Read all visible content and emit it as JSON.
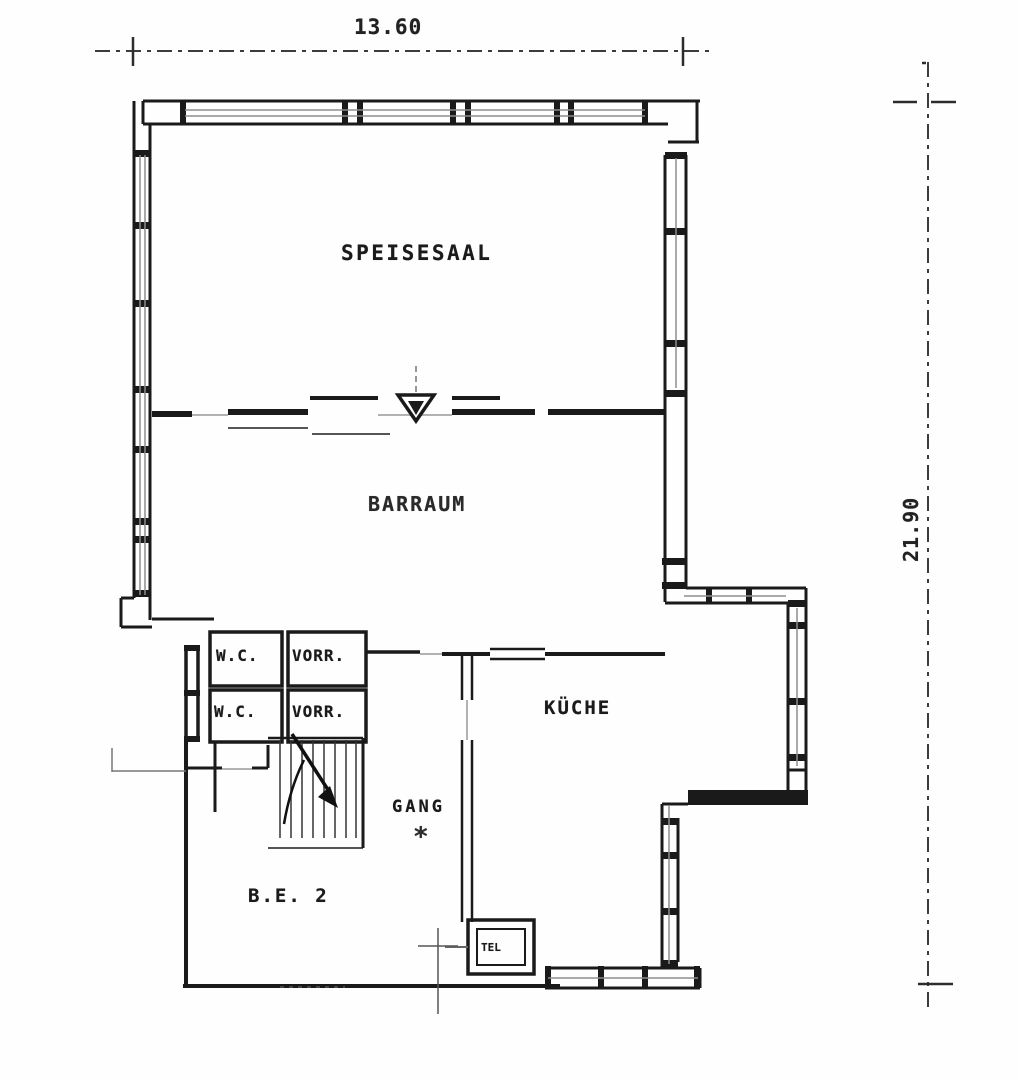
{
  "drawing": {
    "type": "floor-plan",
    "paper_color": "#fefefe",
    "ink_color": "#1a1a1a",
    "glazing_color": "#8d8d8d",
    "dimension_color": "#3c3c3c"
  },
  "dimensions": {
    "width": {
      "label": "13.60"
    },
    "height": {
      "label": "21.90"
    }
  },
  "rooms": {
    "speisesaal": {
      "label": "SPEISESAAL"
    },
    "barraum": {
      "label": "BARRAUM"
    },
    "wc_upper": {
      "label": "W.C."
    },
    "vorr_upper": {
      "label": "VORR."
    },
    "wc_lower": {
      "label": "W.C."
    },
    "vorr_lower": {
      "label": "VORR."
    },
    "kueche": {
      "label": "KÜCHE"
    },
    "gang": {
      "label": "GANG"
    },
    "gang_footnote": {
      "label": "*"
    },
    "be2": {
      "label": "B.E. 2"
    },
    "tel": {
      "label": "TEL"
    }
  }
}
